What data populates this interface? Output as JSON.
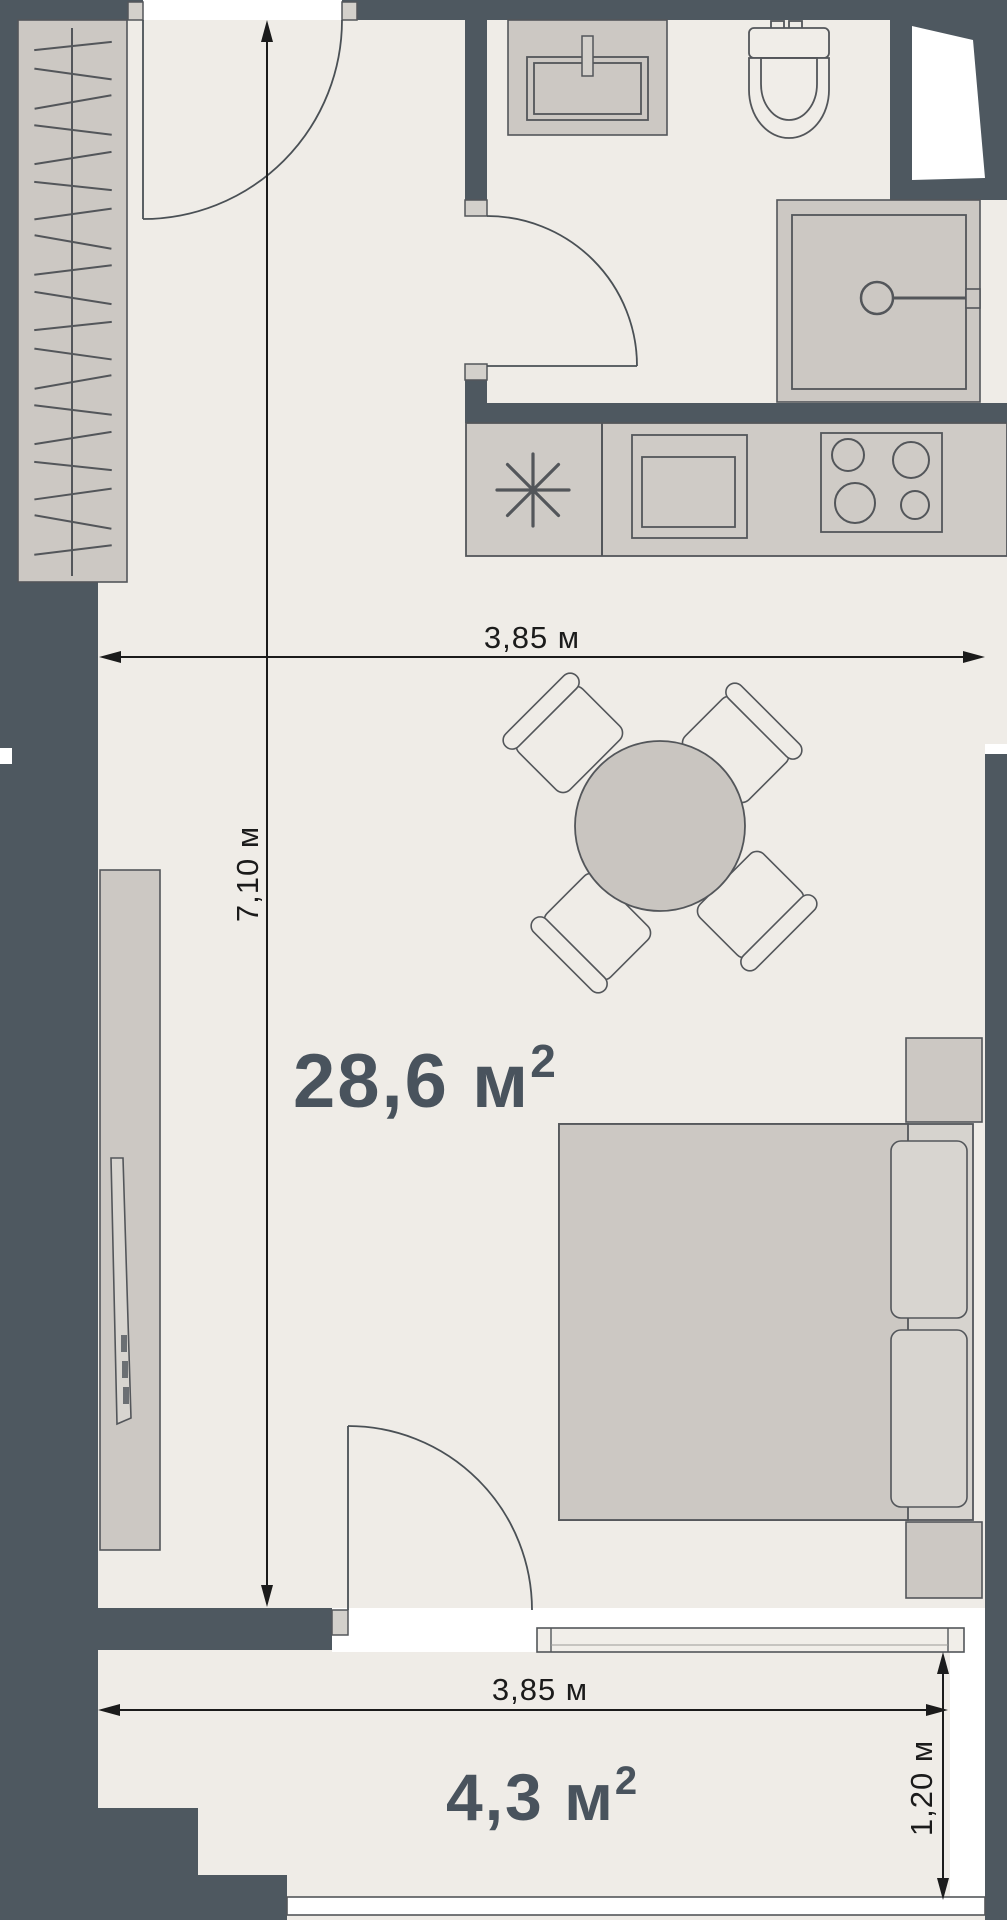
{
  "plan_type": "apartment-floor-plan",
  "areas": {
    "living": "28,6 м",
    "living_sup": "2",
    "balcony": "4,3 м",
    "balcony_sup": "2"
  },
  "dims": {
    "top_width": "3,85 м",
    "left_height": "7,10 м",
    "balcony_width": "3,85 м",
    "balcony_depth": "1,20 м"
  },
  "icons": {
    "wardrobe": "wardrobe-with-hangers",
    "entrance_door": "door-swing",
    "bathroom_door": "door-swing",
    "balcony_door": "door-swing",
    "sink": "bathroom-vanity-sink",
    "toilet": "toilet",
    "shower": "shower-cabin",
    "kitchen_sink": "kitchen-sink-asterisk",
    "kitchen_appliance": "kitchen-basin",
    "hob": "stove-4-burners",
    "dining_table": "round-table-4-chairs",
    "tv": "tv-panel",
    "bed": "double-bed-with-pillows",
    "window": "balcony-glazing"
  },
  "colors": {
    "wall": "#4E5860",
    "floor": "#EFECE7",
    "furniture_fill": "#CCC8C3",
    "furniture_fill_dark": "#C9C5C0",
    "furniture_stroke": "#53565A",
    "line": "#1B1B1B",
    "area_text": "#49535D",
    "opening": "#FFFFFF"
  }
}
